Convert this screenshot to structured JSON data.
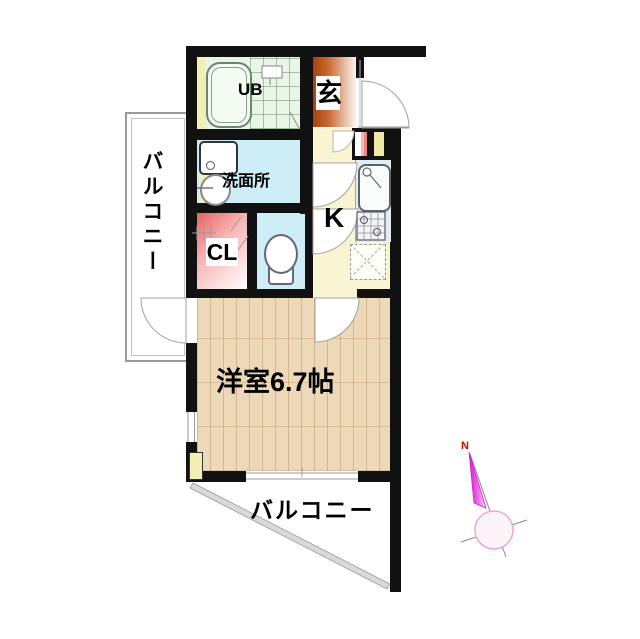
{
  "plan": {
    "rooms": {
      "ub": {
        "label": "UB"
      },
      "genkan": {
        "label": "玄"
      },
      "washroom": {
        "label": "洗面所"
      },
      "closet": {
        "label": "CL"
      },
      "kitchen": {
        "label": "K"
      },
      "main_room": {
        "label": "洋室6.7帖"
      },
      "balcony_left": {
        "label": "バルコニー"
      },
      "balcony_bottom": {
        "label": "バルコニー"
      }
    },
    "compass": {
      "north_label": "N"
    },
    "fixtures": [
      "bathtub",
      "ub-sink",
      "washing-machine",
      "wash-basin",
      "toilet",
      "kitchen-sink",
      "gas-stove",
      "refrigerator-space"
    ],
    "colors": {
      "wall": "#111111",
      "ub_floor": "#e9f5e6",
      "genkan_floor": "#a8430e",
      "washroom_floor": "#cdeef7",
      "toilet_floor": "#cdeef7",
      "closet_floor": "#e45858",
      "kitchen_floor": "#f9f5d2",
      "wood_floor": "#edd9b8",
      "pipe_space": "#f2eeb5",
      "compass_needle": "#e020e0",
      "north_text": "#dd0000"
    }
  }
}
